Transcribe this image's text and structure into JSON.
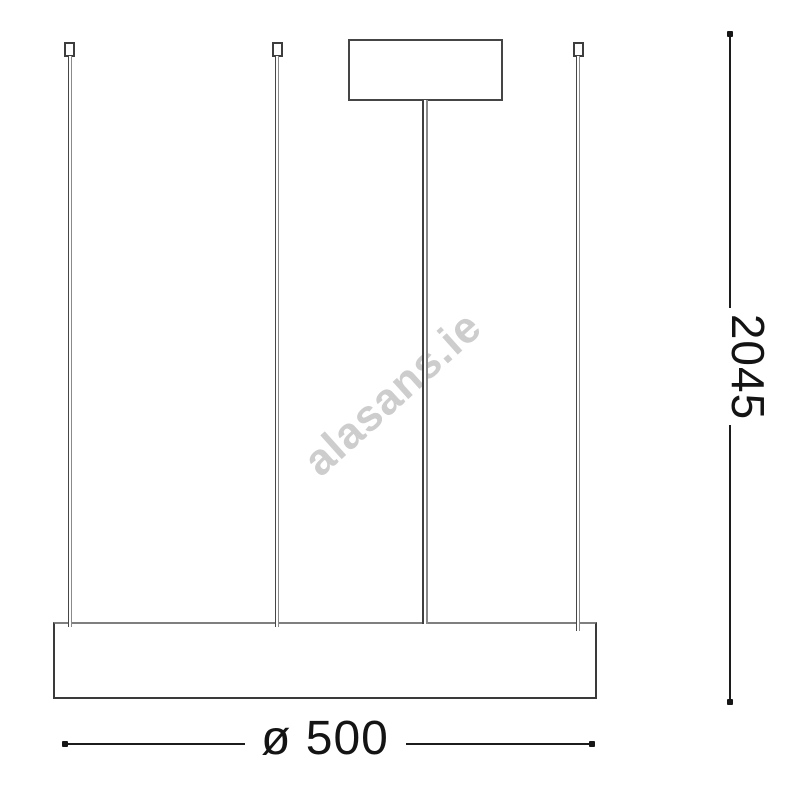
{
  "drawing": {
    "subject": "pendant-lamp-dimension-drawing",
    "parts": {
      "canopy": "ceiling-canopy",
      "rod": "central-suspension-rod",
      "wires": "suspension-wires",
      "body": "ring-lamp-body-side-view"
    }
  },
  "dimensions": {
    "height_label": "2045",
    "diameter_label": "ø 500"
  },
  "watermark": {
    "text": "alasans.ie"
  },
  "colors": {
    "background": "#ffffff",
    "drawing_line": "#3f3f3f",
    "dimension_line": "#1c1c1c",
    "dimension_text": "#141414",
    "watermark_text": "#cdcdcd"
  }
}
